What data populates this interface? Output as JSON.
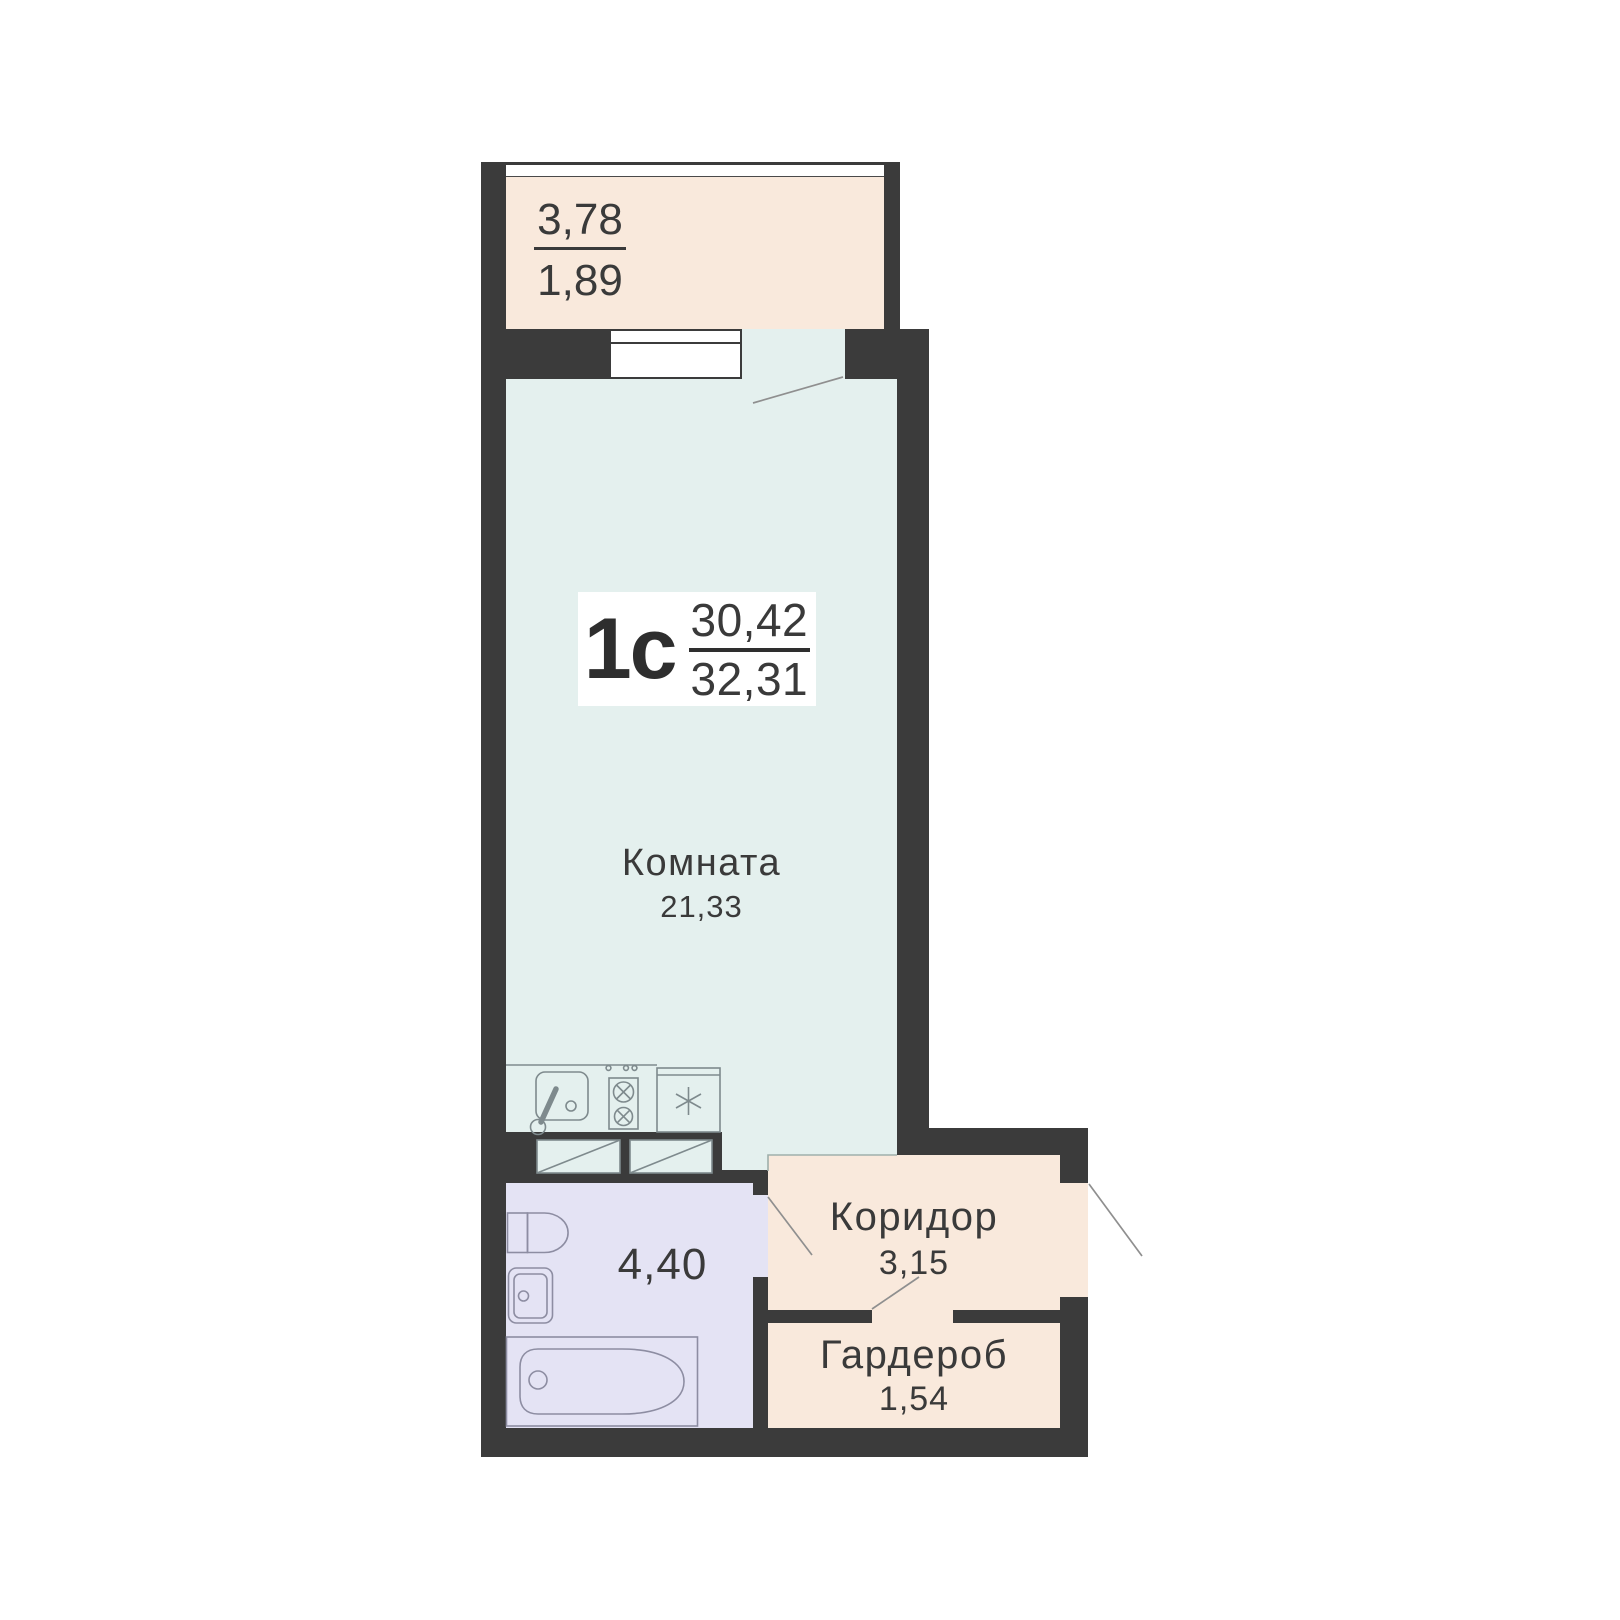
{
  "unit": {
    "type_label": "1с",
    "living_area": "30,42",
    "total_area": "32,31"
  },
  "rooms": {
    "balcony": {
      "area_full": "3,78",
      "area_reduced": "1,89"
    },
    "living": {
      "name": "Комната",
      "area": "21,33"
    },
    "bathroom": {
      "area": "4,40"
    },
    "corridor": {
      "name": "Коридор",
      "area": "3,15"
    },
    "wardrobe": {
      "name": "Гардероб",
      "area": "1,54"
    }
  },
  "icons": {
    "kitchen": [
      "kitchen-sink-icon",
      "stove-icon",
      "fridge-icon"
    ],
    "bathroom": [
      "toilet-icon",
      "washbasin-icon",
      "bathtub-icon"
    ],
    "other": [
      "closet-icon",
      "window-icon",
      "door-swing-icon",
      "balcony-glazing-icon"
    ]
  },
  "colors": {
    "wall": "#3b3b3b",
    "balcony_fill": "#f9e9dc",
    "corridor_fill": "#f9e9dc",
    "wardrobe_fill": "#f9e9dc",
    "living_fill": "#e4f0ee",
    "bathroom_fill": "#e4e3f4",
    "fixture_line": "#7e8a8d",
    "text": "#3a3a3a",
    "background": "#ffffff"
  }
}
